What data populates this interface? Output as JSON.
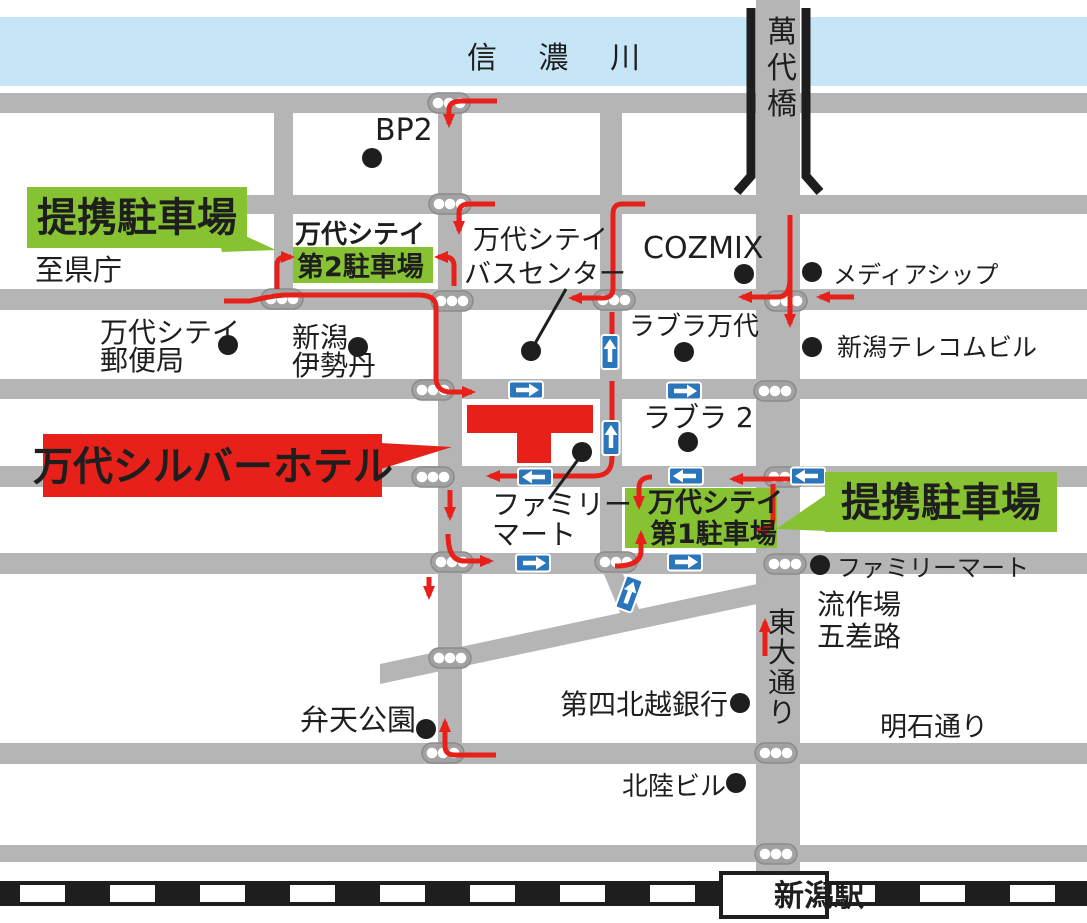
{
  "map": {
    "region_labels": {
      "river": "信 濃 川",
      "bridge": "萬代橋",
      "station": "新潟駅",
      "to_prefecture": "至県庁",
      "higashi_odori": "東大通り",
      "akashi_dori": "明石通り",
      "gosaro": [
        "流作場",
        "五差路"
      ]
    },
    "hotel": {
      "label": "万代シルバーホテル"
    },
    "partner_parking_badge": "提携駐車場",
    "parking_no2": [
      "万代シテイ",
      "第2駐車場"
    ],
    "parking_no1": [
      "万代シテイ",
      "第1駐車場"
    ],
    "pois": {
      "bp2": "BP2",
      "bandai_post_office": [
        "万代シテイ",
        "郵便局"
      ],
      "niigata_isetan": [
        "新潟",
        "伊勢丹"
      ],
      "bus_center": [
        "万代シテイ",
        "バスセンター"
      ],
      "cozmix": "COZMIX",
      "media_ship": "メディアシップ",
      "lovela_bandai": "ラブラ万代",
      "niigata_telecom_bldg": "新潟テレコムビル",
      "lovela_2": "ラブラ 2",
      "family_mart_hotel": [
        "ファミリー",
        "マート"
      ],
      "family_mart_east": "ファミリーマート",
      "daishi_hokuetsu_bank": "第四北越銀行",
      "benten_park": "弁天公園",
      "hokuriku_bldg": "北陸ビル"
    },
    "colors": {
      "road": "#b5b5b6",
      "river": "#c6e5f7",
      "green": "#87c232",
      "red": "#e7211a",
      "blue": "#2b76bb",
      "ink": "#1e1e1e"
    },
    "icons": {
      "traffic_light": "traffic-light-icon",
      "poi_dot": "poi-dot-icon",
      "one_way": "one-way-arrow-icon",
      "route": "route-arrow-icon",
      "railway": "railway-stripe-icon",
      "bridge_rail": "bridge-guardrail-icon"
    }
  }
}
